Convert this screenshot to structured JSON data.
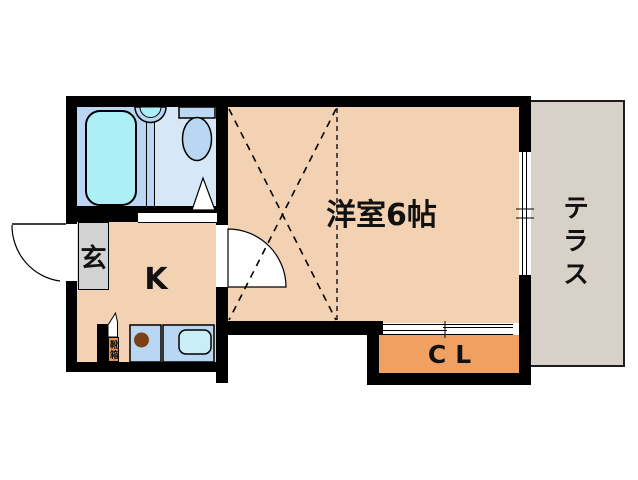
{
  "floorplan": {
    "rooms": {
      "western_room": {
        "label": "洋室6帖"
      },
      "kitchen": {
        "label": "K"
      },
      "entrance": {
        "label": "玄"
      },
      "closet": {
        "label": "CL"
      },
      "terrace": {
        "label": "テラス"
      },
      "shoe_box": {
        "label": "靴箱"
      }
    },
    "colors": {
      "wall": "#000000",
      "floor_main": "#f2d2b2",
      "terrace_fill": "#d8d1c9",
      "entrance_fill": "#d2d2d2",
      "closet_fill": "#f0a161",
      "shoe_box_fill": "#e78f4c",
      "bath_room_fill": "#b9d6f2",
      "toilet_room_fill": "#d6e8f8",
      "water_fill": "#adeff7",
      "kitchen_counter_fill": "#b9d6f2",
      "kitchen_sink_fill": "#c9eef6",
      "stove_burner_fill": "#7b4116"
    },
    "fixtures": {
      "bathtub": "bathtub",
      "wash_basin": "wash-basin",
      "toilet": "toilet",
      "bath_door": "bath-door",
      "entrance_door": "entrance-door",
      "room_door": "room-door",
      "stove_burner": "stove-burner",
      "kitchen_sink": "kitchen-sink",
      "window_right": "sliding-window",
      "window_closet": "sliding-window"
    }
  }
}
